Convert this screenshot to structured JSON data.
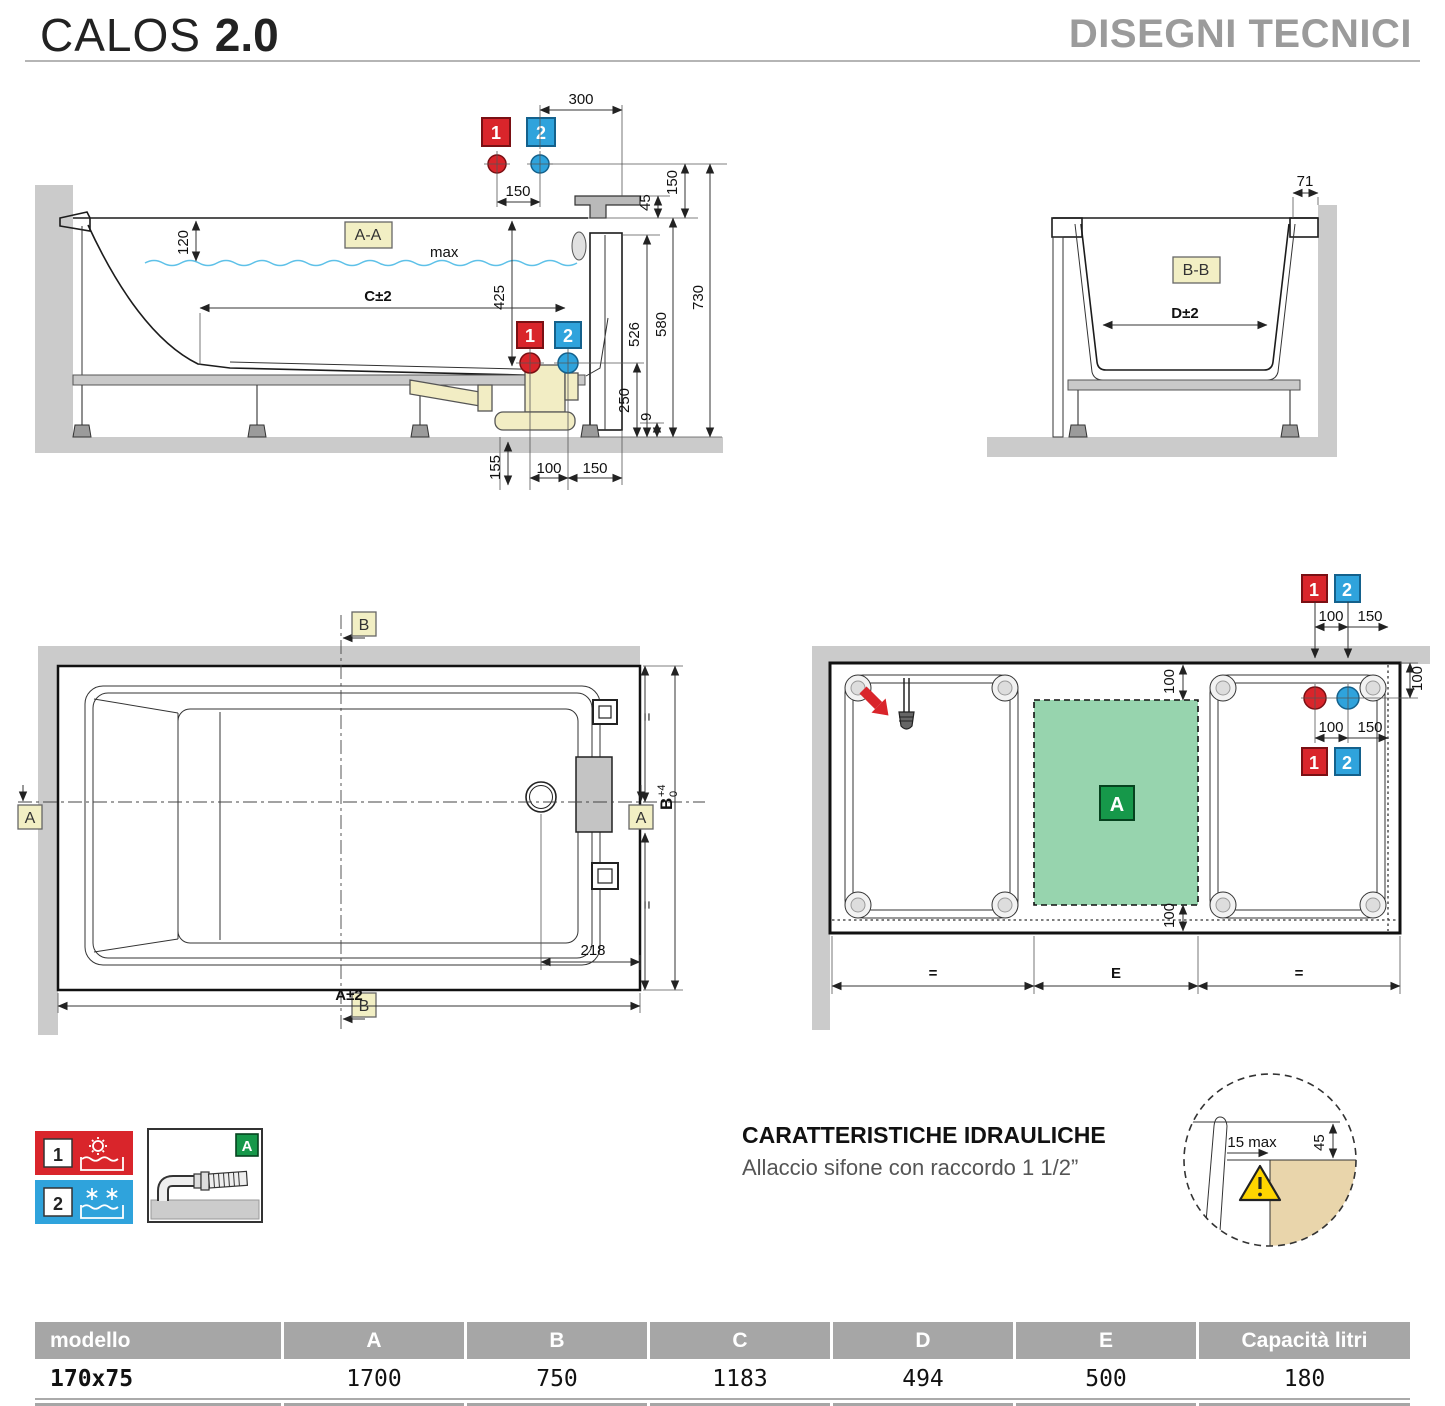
{
  "header": {
    "brand": "CALOS",
    "version": "2.0",
    "title": "DISEGNI TECNICI"
  },
  "section_aa": {
    "label": "A-A",
    "water_max": "max",
    "d300": "300",
    "d150top": "150",
    "d45": "45",
    "d150right": "150",
    "d730": "730",
    "d580": "580",
    "d526": "526",
    "d425": "425",
    "d120": "120",
    "dC": "C±2",
    "d250": "250",
    "d9": "9",
    "d155": "155",
    "d100": "100",
    "d150bot": "150",
    "n1": "1",
    "n2": "2"
  },
  "section_bb": {
    "label": "B-B",
    "d71": "71",
    "dD": "D±2"
  },
  "plan": {
    "markerA": "A",
    "markerB": "B",
    "d218": "218",
    "dA": "A±2",
    "dB": "B",
    "dBsup": "+4",
    "dBsub": "0",
    "eq": "="
  },
  "install": {
    "d100": "100",
    "d150": "150",
    "dE": "E",
    "eq": "=",
    "n1": "1",
    "n2": "2",
    "area": "A"
  },
  "detail": {
    "d15": "15 max",
    "d45": "45"
  },
  "legend": {
    "n1": "1",
    "n2": "2",
    "area": "A"
  },
  "hydraulics": {
    "title": "CARATTERISTICHE IDRAULICHE",
    "subtitle": "Allaccio sifone con raccordo 1 1/2”"
  },
  "table": {
    "headers": [
      "modello",
      "A",
      "B",
      "C",
      "D",
      "E",
      "Capacità litri"
    ],
    "row": [
      "170x75",
      "1700",
      "750",
      "1183",
      "494",
      "500",
      "180"
    ]
  },
  "colors": {
    "hot": "#d9252b",
    "cold": "#2fa3dc",
    "accent_green": "#16984a",
    "area_green": "#97d4ae",
    "label_beige": "#f2efc4",
    "wall_gray": "#cbcbcb",
    "warn_yellow": "#ffd500",
    "tile_tan": "#e9d5ab"
  }
}
